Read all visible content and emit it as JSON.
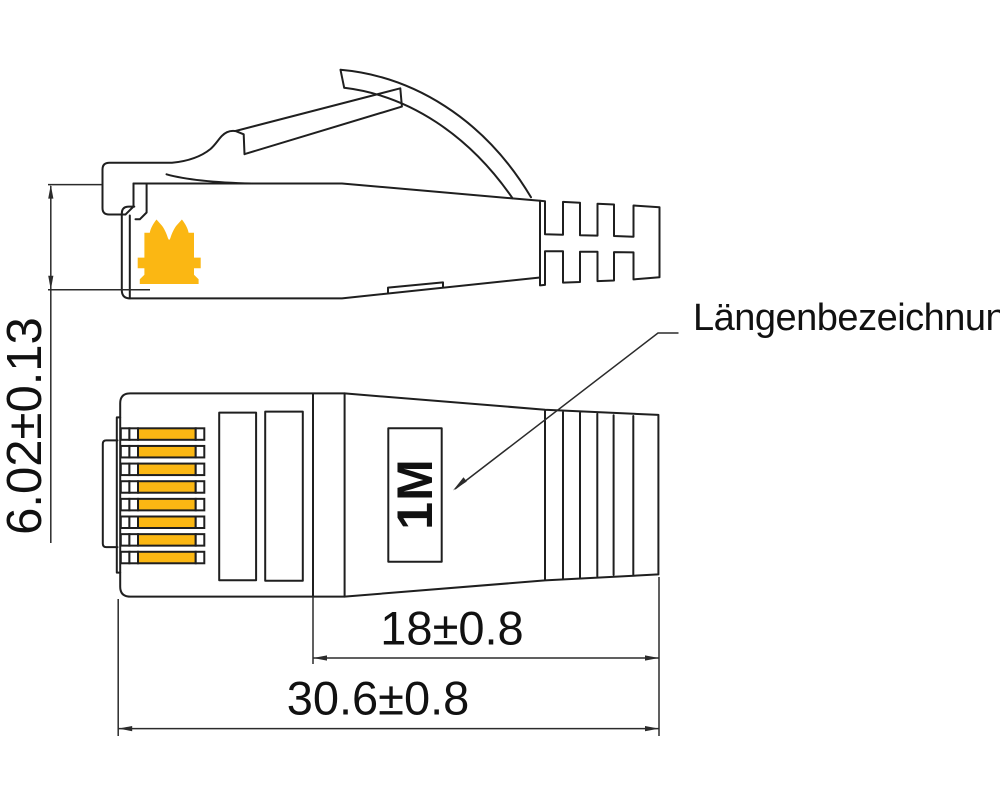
{
  "labels": {
    "length_designation": "Längenbezeichnung",
    "length_marking": "1M"
  },
  "dimensions": {
    "plug_height": "6.02±0.13",
    "boot_length": "18±0.8",
    "overall_length": "30.6±0.8"
  },
  "plan_view": {
    "pin_count": 8
  },
  "colors": {
    "accent": "#FBB713",
    "line": "#1F1F1F",
    "dim_line": "#2B2B2B",
    "background": "#FFFFFF"
  }
}
